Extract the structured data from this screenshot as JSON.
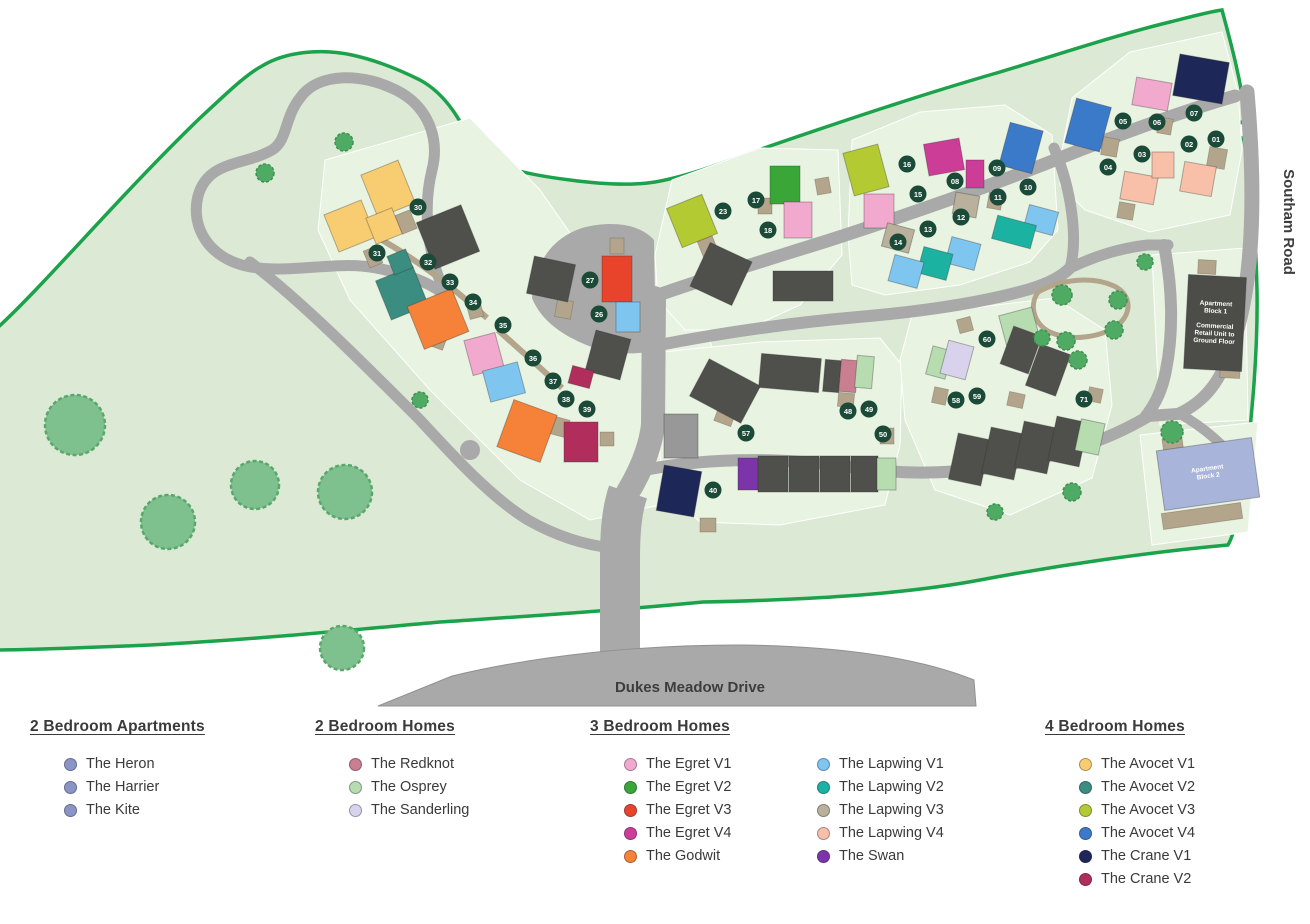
{
  "map": {
    "site_fill": "#dce9d5",
    "parcel_fill": "#e9f3e1",
    "boundary_color": "#1ba24b",
    "road_fill": "#a9a9a9",
    "road_edge": "#919191",
    "path_color": "#b3a48c",
    "badge_color": "#1b4a38",
    "badge_text_color": "#ffffff",
    "tree_big_fill": "#7fc18e",
    "tree_big_edge": "#58a86b",
    "tree_small_fill": "#4fab63",
    "tree_small_edge": "#3c9150",
    "labels": {
      "southam_road": "Southam Road",
      "dukes_meadow_drive": "Dukes Meadow Drive"
    },
    "apartment_blocks": [
      {
        "name": "apartment-block-1",
        "x": 1186,
        "y": 276,
        "w": 58,
        "h": 94,
        "rot": 3,
        "color": "#4c4c49",
        "text_color": "#ffffff",
        "lines": [
          "Apartment",
          "Block 1",
          "",
          "Commercial",
          "Retail Unit to",
          "Ground Floor"
        ]
      },
      {
        "name": "apartment-block-2",
        "x": 1160,
        "y": 444,
        "w": 96,
        "h": 60,
        "rot": -8,
        "color": "#a9b4da",
        "text_color": "#ffffff",
        "lines": [
          "Apartment",
          "Block 2"
        ]
      }
    ],
    "house_colors": {
      "redknot": "#c97f8f",
      "osprey": "#b7dcb0",
      "sanderling": "#d9d2ec",
      "egret_v1": "#f2a9ce",
      "egret_v2": "#3aa637",
      "egret_v3": "#e8432b",
      "egret_v4": "#cb3d97",
      "godwit": "#f58238",
      "lapwing_v1": "#7ec5ef",
      "lapwing_v2": "#1cb2a2",
      "lapwing_v3": "#b9b19c",
      "lapwing_v4": "#f8bfa9",
      "swan": "#7c35a8",
      "avocet_v1": "#f8cd72",
      "avocet_v2": "#3a8d80",
      "avocet_v3": "#b4ca33",
      "avocet_v4": "#3b7ac9",
      "crane_v1": "#1d2758",
      "crane_v2": "#b12d5c",
      "unreleased": "#4f4f4c",
      "gray_block": "#989898"
    },
    "houses": [
      [
        "avocet_v1",
        368,
        166,
        40,
        46,
        -22
      ],
      [
        "avocet_v1",
        330,
        206,
        40,
        40,
        -22
      ],
      [
        "avocet_v1",
        370,
        212,
        28,
        28,
        -22
      ],
      [
        "unreleased",
        424,
        212,
        48,
        50,
        -22
      ],
      [
        "avocet_v2",
        382,
        272,
        40,
        42,
        -22
      ],
      [
        "avocet_v2",
        390,
        252,
        20,
        20,
        -22
      ],
      [
        "godwit",
        414,
        296,
        48,
        46,
        -22
      ],
      [
        "egret_v1",
        468,
        336,
        32,
        36,
        -15
      ],
      [
        "lapwing_v1",
        486,
        366,
        36,
        32,
        -15
      ],
      [
        "unreleased",
        530,
        260,
        42,
        38,
        12
      ],
      [
        "egret_v3",
        602,
        256,
        30,
        46,
        0
      ],
      [
        "lapwing_v1",
        616,
        302,
        24,
        30,
        0
      ],
      [
        "unreleased",
        590,
        334,
        36,
        42,
        15
      ],
      [
        "crane_v2",
        570,
        368,
        22,
        18,
        15
      ],
      [
        "godwit",
        504,
        406,
        46,
        50,
        20
      ],
      [
        "crane_v2",
        564,
        422,
        34,
        40,
        0
      ],
      [
        "gray_block",
        664,
        414,
        34,
        44,
        0
      ],
      [
        "crane_v1",
        660,
        468,
        38,
        46,
        10
      ],
      [
        "avocet_v3",
        673,
        200,
        38,
        42,
        -22
      ],
      [
        "egret_v2",
        770,
        166,
        30,
        38,
        0
      ],
      [
        "egret_v1",
        784,
        202,
        28,
        36,
        0
      ],
      [
        "unreleased",
        698,
        250,
        46,
        48,
        25
      ],
      [
        "unreleased",
        773,
        271,
        60,
        30,
        0
      ],
      [
        "avocet_v3",
        848,
        148,
        36,
        44,
        -15
      ],
      [
        "egret_v1",
        864,
        194,
        30,
        34,
        0
      ],
      [
        "lapwing_v3",
        884,
        226,
        28,
        24,
        15
      ],
      [
        "lapwing_v3",
        954,
        194,
        24,
        22,
        10
      ],
      [
        "egret_v4",
        926,
        141,
        36,
        32,
        -10
      ],
      [
        "egret_v4",
        966,
        160,
        18,
        28,
        0
      ],
      [
        "avocet_v4",
        1004,
        126,
        34,
        44,
        15
      ],
      [
        "lapwing_v1",
        1026,
        208,
        30,
        24,
        15
      ],
      [
        "lapwing_v2",
        994,
        220,
        40,
        24,
        15
      ],
      [
        "lapwing_v1",
        948,
        240,
        30,
        27,
        15
      ],
      [
        "lapwing_v2",
        920,
        250,
        30,
        27,
        15
      ],
      [
        "lapwing_v1",
        891,
        258,
        30,
        27,
        15
      ],
      [
        "avocet_v4",
        1070,
        102,
        36,
        46,
        15
      ],
      [
        "egret_v1",
        1134,
        80,
        36,
        28,
        10
      ],
      [
        "crane_v1",
        1176,
        58,
        50,
        42,
        10
      ],
      [
        "lapwing_v4",
        1122,
        174,
        34,
        28,
        10
      ],
      [
        "lapwing_v4",
        1152,
        152,
        22,
        26,
        0
      ],
      [
        "lapwing_v4",
        1182,
        164,
        32,
        30,
        10
      ],
      [
        "unreleased",
        696,
        370,
        58,
        42,
        28
      ],
      [
        "unreleased",
        760,
        356,
        60,
        34,
        5
      ],
      [
        "unreleased",
        824,
        360,
        16,
        32,
        5
      ],
      [
        "redknot",
        840,
        360,
        17,
        32,
        5
      ],
      [
        "osprey",
        856,
        356,
        17,
        32,
        5
      ],
      [
        "swan",
        738,
        458,
        20,
        32,
        0
      ],
      [
        "unreleased",
        758,
        456,
        30,
        36,
        0
      ],
      [
        "unreleased",
        789,
        456,
        30,
        36,
        0
      ],
      [
        "unreleased",
        820,
        456,
        30,
        36,
        0
      ],
      [
        "unreleased",
        851,
        456,
        27,
        36,
        0
      ],
      [
        "osprey",
        877,
        458,
        19,
        32,
        0
      ],
      [
        "osprey",
        1002,
        311,
        34,
        30,
        -15
      ],
      [
        "osprey",
        929,
        348,
        20,
        29,
        15
      ],
      [
        "sanderling",
        944,
        343,
        26,
        34,
        15
      ],
      [
        "unreleased",
        1006,
        330,
        30,
        40,
        20
      ],
      [
        "unreleased",
        1032,
        348,
        32,
        44,
        20
      ],
      [
        "unreleased",
        953,
        436,
        33,
        47,
        12
      ],
      [
        "unreleased",
        986,
        430,
        33,
        47,
        12
      ],
      [
        "unreleased",
        1019,
        424,
        33,
        47,
        12
      ],
      [
        "unreleased",
        1052,
        419,
        32,
        45,
        12
      ],
      [
        "osprey",
        1078,
        421,
        24,
        32,
        12
      ]
    ],
    "garages": [
      [
        398,
        212,
        16,
        20,
        -22
      ],
      [
        366,
        248,
        14,
        18,
        -22
      ],
      [
        430,
        330,
        16,
        18,
        20
      ],
      [
        468,
        302,
        14,
        16,
        -15
      ],
      [
        556,
        300,
        16,
        18,
        10
      ],
      [
        610,
        238,
        14,
        16,
        0
      ],
      [
        552,
        418,
        16,
        18,
        15
      ],
      [
        600,
        432,
        14,
        14,
        0
      ],
      [
        700,
        238,
        16,
        18,
        -22
      ],
      [
        758,
        198,
        14,
        16,
        0
      ],
      [
        816,
        178,
        14,
        16,
        -10
      ],
      [
        988,
        193,
        14,
        16,
        10
      ],
      [
        1102,
        138,
        16,
        18,
        10
      ],
      [
        1158,
        118,
        14,
        16,
        10
      ],
      [
        1208,
        148,
        18,
        20,
        10
      ],
      [
        1118,
        203,
        16,
        16,
        10
      ],
      [
        716,
        408,
        18,
        16,
        20
      ],
      [
        838,
        393,
        16,
        14,
        5
      ],
      [
        880,
        428,
        14,
        16,
        0
      ],
      [
        700,
        518,
        16,
        14,
        0
      ],
      [
        933,
        388,
        14,
        16,
        12
      ],
      [
        1008,
        393,
        16,
        14,
        12
      ],
      [
        1088,
        388,
        14,
        14,
        12
      ],
      [
        958,
        318,
        14,
        14,
        -15
      ],
      [
        1198,
        260,
        18,
        14,
        3
      ],
      [
        1220,
        364,
        20,
        14,
        3
      ],
      [
        1163,
        438,
        20,
        16,
        -8
      ],
      [
        1162,
        508,
        80,
        16,
        -8
      ],
      [
        1232,
        468,
        16,
        30,
        -8
      ]
    ],
    "trees": {
      "big": [
        [
          75,
          425,
          30
        ],
        [
          168,
          522,
          27
        ],
        [
          255,
          485,
          24
        ],
        [
          345,
          492,
          27
        ],
        [
          342,
          648,
          22
        ]
      ],
      "small": [
        [
          265,
          173,
          9
        ],
        [
          344,
          142,
          9
        ],
        [
          420,
          400,
          8
        ],
        [
          1062,
          295,
          10
        ],
        [
          1118,
          300,
          9
        ],
        [
          1114,
          330,
          9
        ],
        [
          1066,
          341,
          9
        ],
        [
          1042,
          338,
          8
        ],
        [
          1078,
          360,
          9
        ],
        [
          1145,
          262,
          8
        ],
        [
          1172,
          432,
          11
        ],
        [
          995,
          512,
          8
        ],
        [
          1072,
          492,
          9
        ]
      ]
    },
    "plots": [
      [
        "01",
        1216,
        139
      ],
      [
        "02",
        1189,
        144
      ],
      [
        "03",
        1142,
        154
      ],
      [
        "04",
        1108,
        167
      ],
      [
        "05",
        1123,
        121
      ],
      [
        "06",
        1157,
        122
      ],
      [
        "07",
        1194,
        113
      ],
      [
        "08",
        955,
        181
      ],
      [
        "09",
        997,
        168
      ],
      [
        "10",
        1028,
        187
      ],
      [
        "11",
        998,
        197
      ],
      [
        "12",
        961,
        217
      ],
      [
        "13",
        928,
        229
      ],
      [
        "14",
        898,
        242
      ],
      [
        "15",
        918,
        194
      ],
      [
        "16",
        907,
        164
      ],
      [
        "17",
        756,
        200
      ],
      [
        "18",
        768,
        230
      ],
      [
        "23",
        723,
        211
      ],
      [
        "26",
        599,
        314
      ],
      [
        "27",
        590,
        280
      ],
      [
        "30",
        418,
        207
      ],
      [
        "31",
        377,
        253
      ],
      [
        "32",
        428,
        262
      ],
      [
        "33",
        450,
        282
      ],
      [
        "34",
        473,
        302
      ],
      [
        "35",
        503,
        325
      ],
      [
        "36",
        533,
        358
      ],
      [
        "37",
        553,
        381
      ],
      [
        "38",
        566,
        399
      ],
      [
        "39",
        587,
        409
      ],
      [
        "40",
        713,
        490
      ],
      [
        "48",
        848,
        411
      ],
      [
        "49",
        869,
        409
      ],
      [
        "50",
        883,
        434
      ],
      [
        "57",
        746,
        433
      ],
      [
        "58",
        956,
        400
      ],
      [
        "59",
        977,
        396
      ],
      [
        "60",
        987,
        339
      ],
      [
        "71",
        1084,
        399
      ]
    ]
  },
  "legend": {
    "columns": [
      {
        "title": "2 Bedroom Apartments",
        "items": [
          {
            "label": "The Heron",
            "color": "#8b95c5"
          },
          {
            "label": "The Harrier",
            "color": "#8b95c5"
          },
          {
            "label": "The Kite",
            "color": "#8b95c5"
          }
        ]
      },
      {
        "title": "2 Bedroom Homes",
        "items": [
          {
            "label": "The Redknot",
            "color": "#c97f8f"
          },
          {
            "label": "The Osprey",
            "color": "#b7dcb0"
          },
          {
            "label": "The Sanderling",
            "color": "#d9d2ec"
          }
        ]
      },
      {
        "title": "3 Bedroom Homes",
        "items": [
          {
            "label": "The Egret V1",
            "color": "#f2a9ce"
          },
          {
            "label": "The Egret V2",
            "color": "#3aa637"
          },
          {
            "label": "The Egret V3",
            "color": "#e8432b"
          },
          {
            "label": "The Egret V4",
            "color": "#cb3d97"
          },
          {
            "label": "The Godwit",
            "color": "#f58238"
          },
          {
            "label": "The Lapwing V1",
            "color": "#7ec5ef"
          },
          {
            "label": "The Lapwing V2",
            "color": "#1cb2a2"
          },
          {
            "label": "The Lapwing V3",
            "color": "#b9b19c"
          },
          {
            "label": "The Lapwing V4",
            "color": "#f8bfa9"
          },
          {
            "label": "The Swan",
            "color": "#7c35a8"
          }
        ]
      },
      {
        "title": "4 Bedroom Homes",
        "items": [
          {
            "label": "The Avocet V1",
            "color": "#f8cd72"
          },
          {
            "label": "The Avocet V2",
            "color": "#3a8d80"
          },
          {
            "label": "The Avocet V3",
            "color": "#b4ca33"
          },
          {
            "label": "The Avocet V4",
            "color": "#3b7ac9"
          },
          {
            "label": "The Crane V1",
            "color": "#1d2758"
          },
          {
            "label": "The Crane V2",
            "color": "#b12d5c"
          }
        ]
      }
    ]
  }
}
